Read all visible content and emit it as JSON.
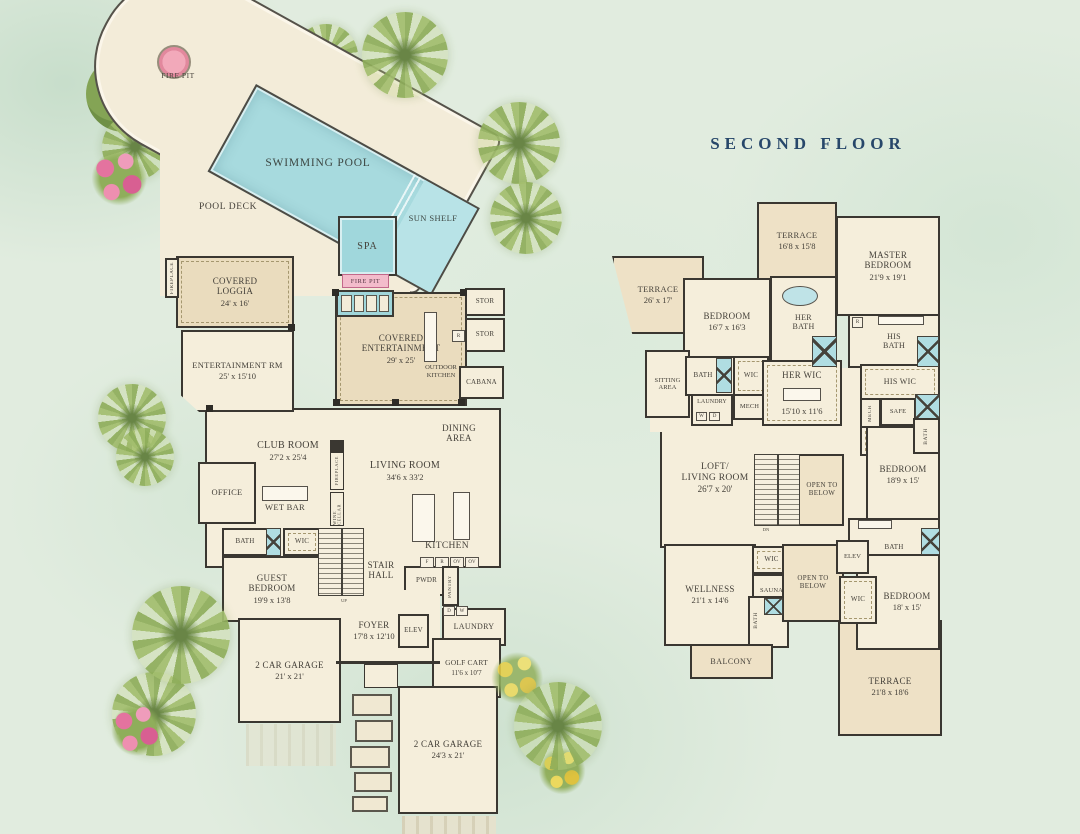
{
  "palette": {
    "background": "#e1ecdf",
    "room_fill": "#f5eedb",
    "covered_fill": "#eadcbe",
    "terrace_fill": "#eee1c6",
    "wall": "#3a3731",
    "pool": "#a7dade",
    "spa": "#a0d7dc",
    "fire_pit_pink": "#f2a9ba",
    "title_navy": "#27476a",
    "label_ink": "#45413a"
  },
  "second_floor_title": "SECOND FLOOR",
  "first_floor": {
    "fire_pit": "FIRE PIT",
    "swimming_pool": "SWIMMING POOL",
    "pool_deck": "POOL DECK",
    "sun_shelf": "SUN SHELF",
    "spa": "SPA",
    "spa_fire_pit": "FIRE PIT",
    "fireplace_loggia": "FIREPLACE",
    "covered_loggia": {
      "name": "COVERED\nLOGGIA",
      "size": "24' x 16'"
    },
    "entertainment_rm": {
      "name": "ENTERTAINMENT RM",
      "size": "25' x 15'10"
    },
    "covered_entertainment": {
      "name": "COVERED\nENTERTAINMENT",
      "size": "29' x 25'"
    },
    "outdoor_kitchen": "OUTDOOR\nKITCHEN",
    "outdoor_fridge": "R",
    "stor_1": "STOR",
    "stor_2": "STOR",
    "cabana": "CABANA",
    "club_room": {
      "name": "CLUB ROOM",
      "size": "27'2 x 25'4"
    },
    "office": "OFFICE",
    "wet_bar": "WET BAR",
    "fireplace_living": "FIREPLACE",
    "wine_cellar": "WINE CELLAR",
    "living_room": {
      "name": "LIVING ROOM",
      "size": "34'6 x 33'2"
    },
    "dining_area": "DINING\nAREA",
    "kitchen": "KITCHEN",
    "appliances": {
      "fridge": "F",
      "range": "R",
      "oven_1": "OV",
      "oven_2": "OV"
    },
    "dryer": "D",
    "washer": "W",
    "bath": "BATH",
    "wic": "WIC",
    "guest_bedroom": {
      "name": "GUEST\nBEDROOM",
      "size": "19'9 x 13'8"
    },
    "stair_hall": "STAIR\nHALL",
    "up": "UP",
    "pwdr": "PWDR",
    "pantry": "PANTRY",
    "laundry": "LAUNDRY",
    "foyer": {
      "name": "FOYER",
      "size": "17'8 x 12'10"
    },
    "elev": "ELEV",
    "garage_1": {
      "name": "2 CAR GARAGE",
      "size": "21' x 21'"
    },
    "golf_cart": {
      "name": "GOLF CART",
      "size": "11'6 x 10'7"
    },
    "garage_2": {
      "name": "2 CAR GARAGE",
      "size": "24'3 x 21'"
    }
  },
  "second_floor": {
    "terrace_left": {
      "name": "TERRACE",
      "size": "26' x 17'"
    },
    "terrace_top": {
      "name": "TERRACE",
      "size": "16'8 x 15'8"
    },
    "master_bedroom": {
      "name": "MASTER\nBEDROOM",
      "size": "21'9 x 19'1"
    },
    "bedroom_1": {
      "name": "BEDROOM",
      "size": "16'7 x 16'3"
    },
    "her_bath": "HER\nBATH",
    "his_bath": "HIS\nBATH",
    "his_bath_chip": "R",
    "sitting_area": "SITTING\nAREA",
    "bath_2": "BATH",
    "wic_2": "WIC",
    "mech_1": "MECH",
    "laundry": "LAUNDRY",
    "washer": "W",
    "dryer": "D",
    "her_wic": {
      "name": "HER WIC",
      "size": "15'10 x 11'6"
    },
    "his_wic": "HIS WIC",
    "mech_2": "MECH",
    "safe": "SAFE",
    "bath_3": "BATH",
    "wic_3": "WIC",
    "loft": {
      "name": "LOFT/\nLIVING ROOM",
      "size": "26'7 x 20'"
    },
    "open_to_below_1": "OPEN TO\nBELOW",
    "dn": "DN",
    "bedroom_2": {
      "name": "BEDROOM",
      "size": "18'9 x 15'"
    },
    "bath_4": "BATH",
    "wellness": {
      "name": "WELLNESS",
      "size": "21'1 x 14'6"
    },
    "wic_4": "WIC",
    "sauna": "SAUNA",
    "bath_5": "BATH",
    "open_to_below_2": "OPEN TO\nBELOW",
    "elev": "ELEV",
    "wic_5": "WIC",
    "bedroom_3": {
      "name": "BEDROOM",
      "size": "18' x 15'"
    },
    "balcony": "BALCONY",
    "terrace_bottom": {
      "name": "TERRACE",
      "size": "21'8 x 18'6"
    }
  }
}
